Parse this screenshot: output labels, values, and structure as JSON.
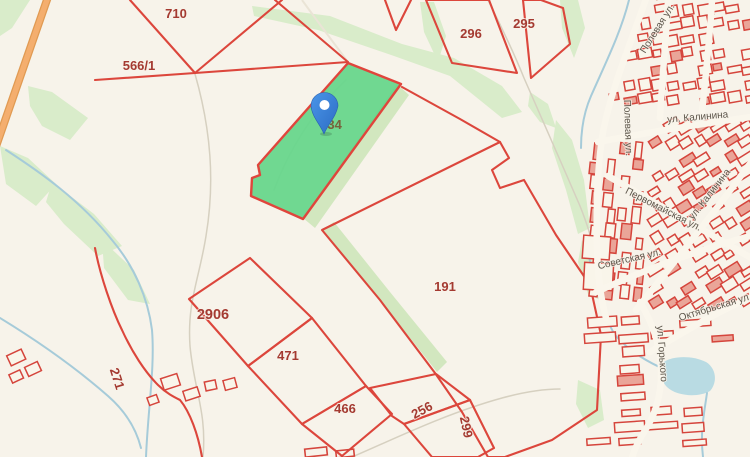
{
  "map": {
    "colors": {
      "background": "#f7f3ea",
      "vegetation": "#d9ecca",
      "water": "#a6cbd9",
      "parcel_line": "#dc463c",
      "highlight_parcel_fill": "#61d587",
      "road_orange": "#f4ae6e",
      "building_line": "#d5453c",
      "parcel_label": "#a43a31",
      "street_label": "#5d564b",
      "pin_blue": "#3e86de"
    },
    "pin": {
      "target_parcel": "734"
    },
    "parcels": [
      {
        "label": "710",
        "highlighted": false
      },
      {
        "label": "566/1",
        "highlighted": false
      },
      {
        "label": "296",
        "highlighted": false
      },
      {
        "label": "295",
        "highlighted": false
      },
      {
        "label": "734",
        "highlighted": true
      },
      {
        "label": "191",
        "highlighted": false
      },
      {
        "label": "2906",
        "highlighted": false
      },
      {
        "label": "471",
        "highlighted": false
      },
      {
        "label": "466",
        "highlighted": false
      },
      {
        "label": "256",
        "highlighted": false
      },
      {
        "label": "299",
        "highlighted": false
      },
      {
        "label": "271",
        "highlighted": false
      }
    ],
    "street_labels": [
      {
        "label": "Полевая ул."
      },
      {
        "label": "Полевая ул."
      },
      {
        "label": "ул. Калинина"
      },
      {
        "label": "ул. Калинина"
      },
      {
        "label": "Первомайская ул."
      },
      {
        "label": "Советская ул."
      },
      {
        "label": "ул. Горького"
      },
      {
        "label": "Октябрьская ул."
      }
    ]
  }
}
